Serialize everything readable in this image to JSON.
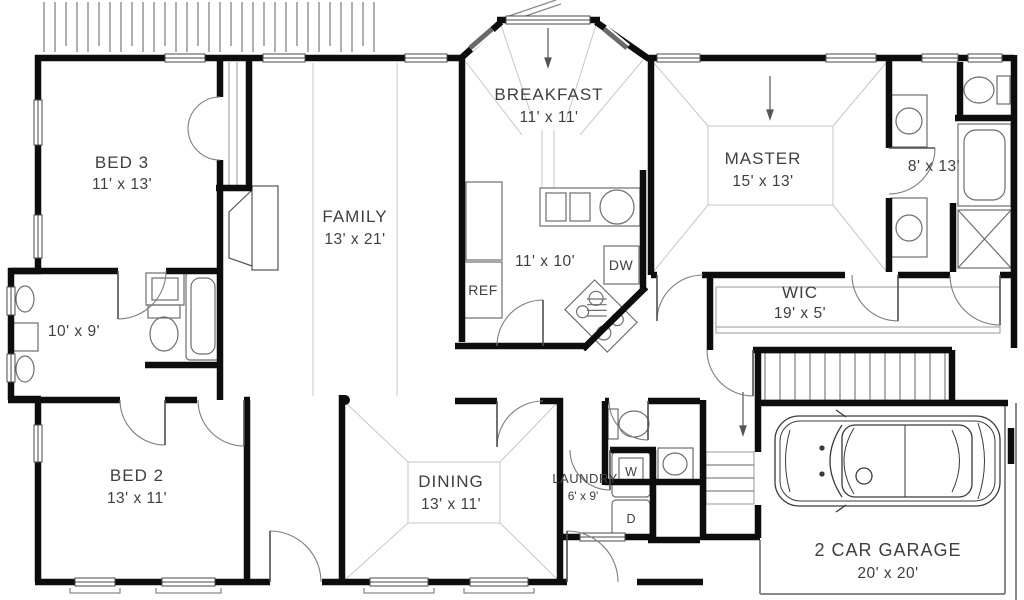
{
  "plan": {
    "title": "single story house floor plan",
    "rooms": {
      "bed3": {
        "name": "BED 3",
        "dims": "11' x 13'"
      },
      "family": {
        "name": "FAMILY",
        "dims": "13' x 21'"
      },
      "breakfast": {
        "name": "BREAKFAST",
        "dims": "11' x 11'"
      },
      "kitchen": {
        "dims": "11' x 10'"
      },
      "master": {
        "name": "MASTER",
        "dims": "15' x 13'"
      },
      "master_bath": {
        "dims": "8' x 13'"
      },
      "wic": {
        "name": "WIC",
        "dims": "19' x 5'"
      },
      "hall_bath": {
        "dims": "10' x 9'"
      },
      "bed2": {
        "name": "BED 2",
        "dims": "13' x 11'"
      },
      "dining": {
        "name": "DINING",
        "dims": "13' x 11'"
      },
      "laundry": {
        "name": "LAUNDRY",
        "dims": "6' x 9'"
      },
      "garage": {
        "name": "2 CAR GARAGE",
        "dims": "20' x 20'"
      }
    },
    "appliances": {
      "refrigerator": "REF",
      "dishwasher": "DW",
      "washer": "W",
      "dryer": "D"
    },
    "colors": {
      "wall": "#0d0d0d",
      "fixture_line": "#6e6e6e",
      "ceiling_line": "#c7c7c7",
      "hatch_line": "#7a7a7a",
      "text": "#3f3f3f",
      "background": "#ffffff"
    }
  }
}
